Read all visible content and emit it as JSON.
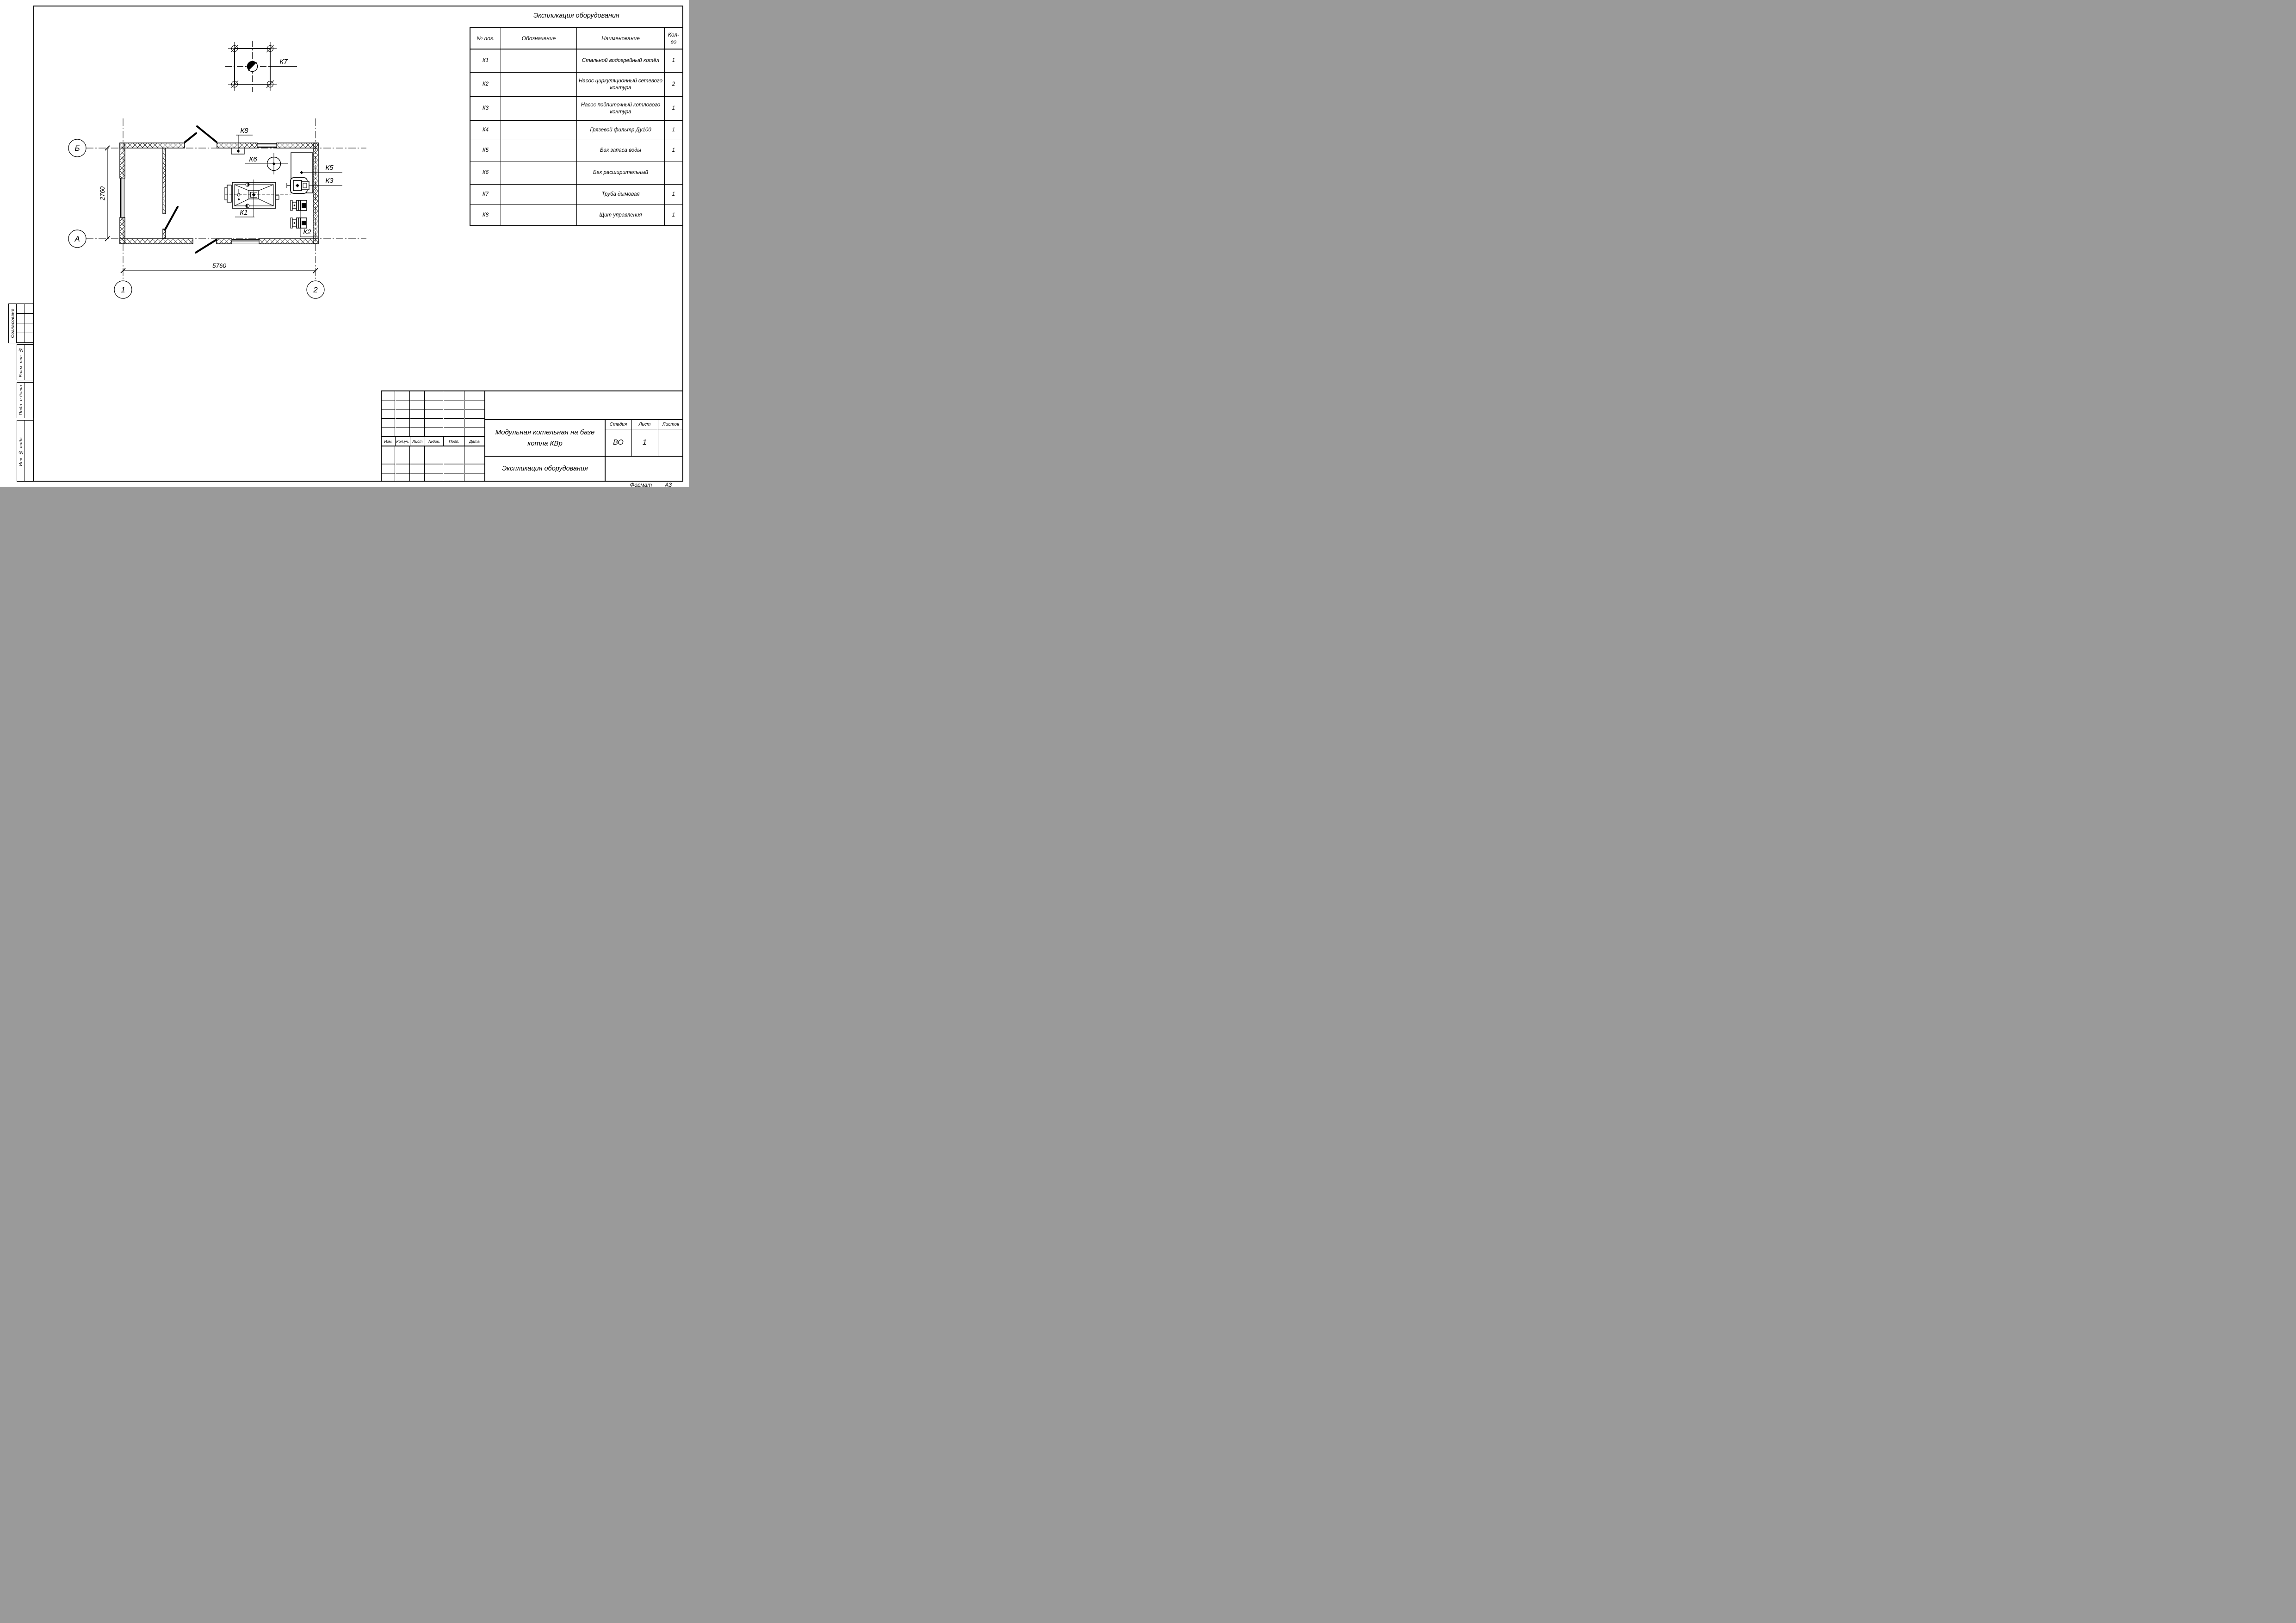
{
  "equipment_table": {
    "title": "Экспликация оборудования",
    "columns": [
      "№ поз.",
      "Обозначение",
      "Наименование",
      "Кол-во"
    ],
    "rows": [
      {
        "pos": "К1",
        "designation": "",
        "name": "Стальной водогрейный котёл",
        "qty": "1"
      },
      {
        "pos": "К2",
        "designation": "",
        "name": "Насос циркуляционный сетевого контура",
        "qty": "2"
      },
      {
        "pos": "К3",
        "designation": "",
        "name": "Насос подпиточный котлового контура",
        "qty": "1"
      },
      {
        "pos": "К4",
        "designation": "",
        "name": "Грязевой фильтр Ду100",
        "qty": "1"
      },
      {
        "pos": "К5",
        "designation": "",
        "name": "Бак запаса воды",
        "qty": "1"
      },
      {
        "pos": "К6",
        "designation": "",
        "name": "Бак расширительный",
        "qty": ""
      },
      {
        "pos": "К7",
        "designation": "",
        "name": "Труба дымовая",
        "qty": "1"
      },
      {
        "pos": "К8",
        "designation": "",
        "name": "Щит управления",
        "qty": "1"
      }
    ]
  },
  "plan": {
    "axis_labels": {
      "b": "Б",
      "a": "А",
      "one": "1",
      "two": "2"
    },
    "dimensions": {
      "width": "5760",
      "height": "2760"
    },
    "labels": {
      "k1": "К1",
      "k2": "К2",
      "k3": "К3",
      "k5": "К5",
      "k6": "К6",
      "k7": "К7",
      "k8": "К8"
    }
  },
  "title_block": {
    "revision_header": [
      "Изм.",
      "Кол.уч.",
      "Лист",
      "№док.",
      "Подп.",
      "Дата"
    ],
    "project_title": "Модульная котельная на базе котла КВр",
    "sheet_title": "Экспликация оборудования",
    "stage_label": "Стадия",
    "stage_value": "ВО",
    "sheet_label": "Лист",
    "sheet_value": "1",
    "sheets_label": "Листов",
    "sheets_value": ""
  },
  "side_stamps": {
    "approved": "Согласовано",
    "replace_inv": "Взам. инв. №",
    "sign_date": "Подп. и дата",
    "inv_orig": "Инв. № подл."
  },
  "format_note": {
    "label": "Формат",
    "value": "А3"
  }
}
